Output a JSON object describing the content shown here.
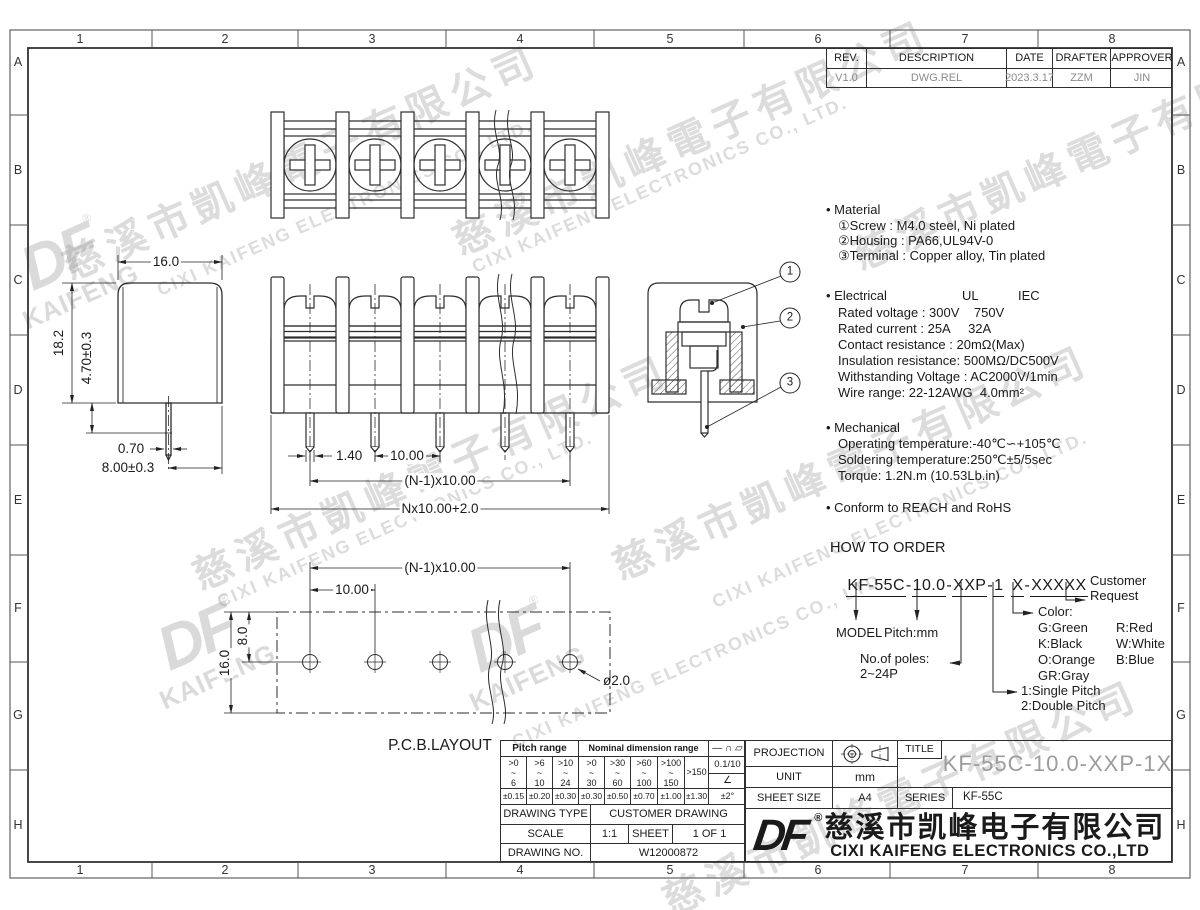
{
  "frame": {
    "cols": [
      "1",
      "2",
      "3",
      "4",
      "5",
      "6",
      "7",
      "8"
    ],
    "rows": [
      "A",
      "B",
      "C",
      "D",
      "E",
      "F",
      "G",
      "H"
    ]
  },
  "revision": {
    "h1": "REV.",
    "h2": "DESCRIPTION",
    "h3": "DATE",
    "h4": "DRAFTER",
    "h5": "APPROVER",
    "v1": "V1.0",
    "v2": "DWG.REL",
    "v3": "2023.3.17",
    "v4": "ZZM",
    "v5": "JIN"
  },
  "notes": {
    "material_title": "• Material",
    "m1": "①Screw : M4.0 steel, Ni plated",
    "m2": "②Housing : PA66,UL94V-0",
    "m3": "③Terminal : Copper alloy, Tin plated",
    "electrical_title": "• Electrical",
    "ul": "UL",
    "iec": "IEC",
    "e1": "Rated voltage : 300V    750V",
    "e2": "Rated current : 25A     32A",
    "e3": "Contact resistance : 20mΩ(Max)",
    "e4": "Insulation resistance: 500MΩ/DC500V",
    "e5": "Withstanding Voltage : AC2000V/1min",
    "e6": "Wire range: 22-12AWG  4.0mm²",
    "mechanical_title": "• Mechanical",
    "mech1": "Operating temperature:-40℃∽+105℃",
    "mech2": "Soldering temperature:250℃±5/5sec",
    "mech3": "Torque: 1.2N.m (10.53Lb.in)",
    "conform": "• Conform to REACH and RoHS"
  },
  "order": {
    "title": "HOW TO ORDER",
    "seg1": "KF-55C",
    "seg2": "10.0",
    "seg3": "XXP",
    "seg4": "1",
    "seg5": "X",
    "seg6": "XXXXX",
    "sep": "-",
    "l_model": "MODEL",
    "l_pitch": "Pitch:mm",
    "l_poles1": "No.of poles:",
    "l_poles2": "2~24P",
    "l_color": "Color:",
    "c_g": "G:Green",
    "c_r": "R:Red",
    "c_k": "K:Black",
    "c_w": "W:White",
    "c_o": "O:Orange",
    "c_b": "B:Blue",
    "c_gr": "GR:Gray",
    "l_single": "1:Single Pitch",
    "l_double": "2:Double Pitch",
    "l_cust1": "Customer",
    "l_cust2": "Request"
  },
  "dims": {
    "side_w": "16.0",
    "side_h": "18.2",
    "side_a": "4.70±0.3",
    "side_pw": "0.70",
    "side_pl": "8.00±0.3",
    "f_pw": "1.40",
    "f_pitch": "10.00",
    "f_span": "(N-1)x10.00",
    "f_total": "Nx10.00+2.0",
    "p_span": "(N-1)x10.00",
    "p_pitch": "10.00",
    "p_row": "8.0",
    "p_h": "16.0",
    "p_hole": "ø2.0",
    "pcb_title": "P.C.B.LAYOUT",
    "c1": "1",
    "c2": "2",
    "c3": "3"
  },
  "tol": {
    "h_pitch": "Pitch range",
    "h_nom": "Nominal dimension range",
    "syms": "—  ∩  ▱",
    "r1": ">0\n~\n6",
    "r2": ">6\n~\n10",
    "r3": ">10\n~\n24",
    "r4": ">0\n~\n30",
    "r5": ">30\n~\n60",
    "r6": ">60\n~\n100",
    "r7": ">100\n~\n150",
    "r8": ">150",
    "flat": "0.1/10",
    "ang": "∠",
    "t1": "±0.15",
    "t2": "±0.20",
    "t3": "±0.30",
    "t4": "±0.30",
    "t5": "±0.50",
    "t6": "±0.70",
    "t7": "±1.00",
    "t8": "±1.30",
    "t9": "±2°",
    "dt_l": "DRAWING TYPE",
    "dt_v": "CUSTOMER DRAWING",
    "sc_l": "SCALE",
    "sc_v": "1:1",
    "sh_l": "SHEET",
    "sh_v": "1 OF 1",
    "no_l": "DRAWING NO.",
    "no_v": "W12000872"
  },
  "tb": {
    "projection": "PROJECTION",
    "title_l": "TITLE",
    "title_v": "KF-55C-10.0-XXP-1X",
    "unit_l": "UNIT",
    "unit_v": "mm",
    "size_l": "SHEET SIZE",
    "size_v": "A4",
    "series_l": "SERIES",
    "series_v": "KF-55C",
    "logo": "DF",
    "reg": "®",
    "cn": "慈溪市凯峰电子有限公司",
    "en": "CIXI KAIFENG ELECTRONICS CO.,LTD"
  },
  "wm": {
    "cn": "慈溪市凱峰電子有限公司",
    "en": "CIXI KAIFENG ELECTRONICS CO., LTD.",
    "logo": "DF",
    "sub": "KAIFENG",
    "reg": "®"
  }
}
